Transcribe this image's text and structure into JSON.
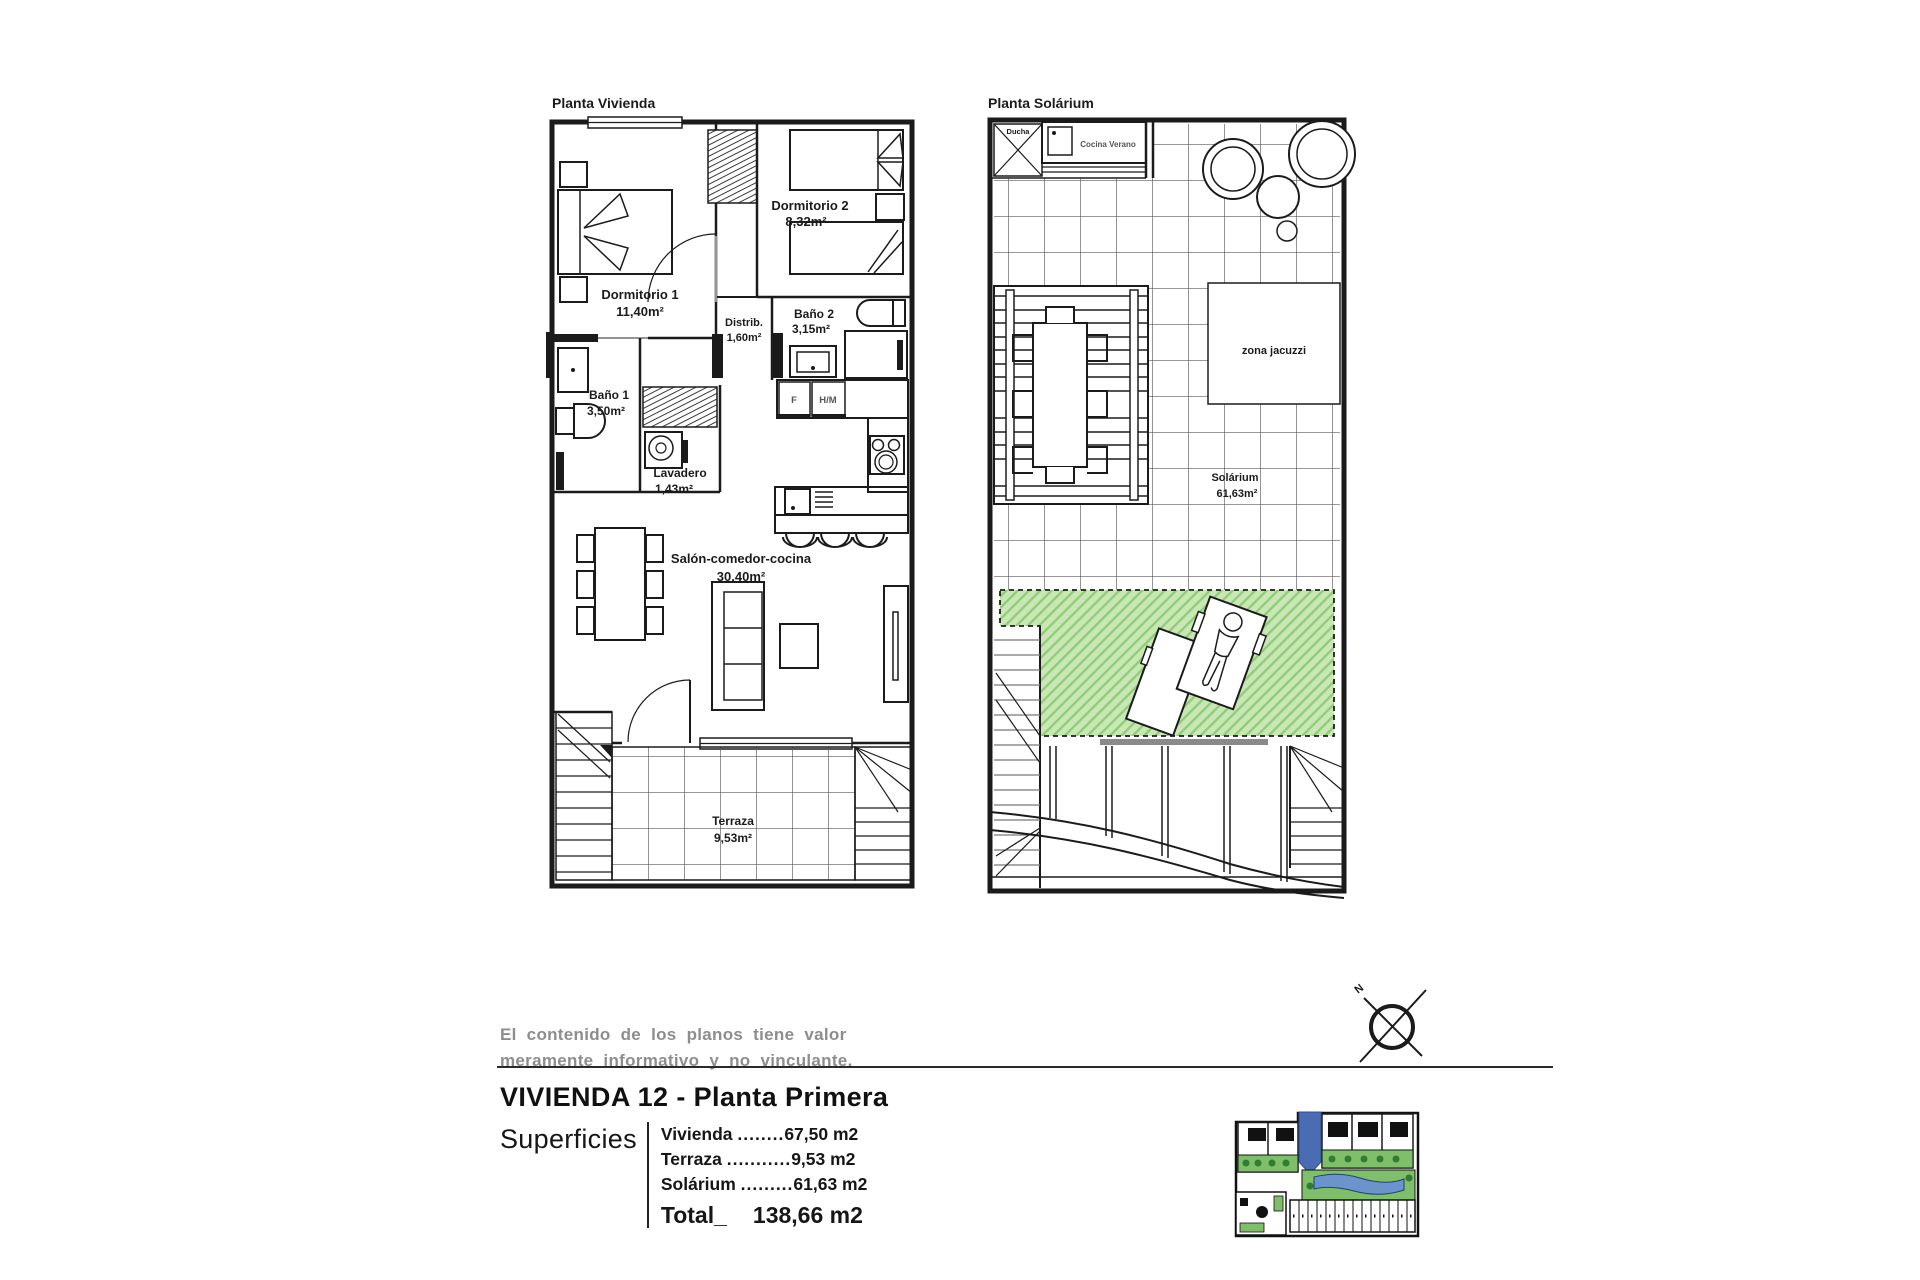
{
  "left_plan": {
    "title": "Planta Vivienda",
    "dormitorio1_name": "Dormitorio 1",
    "dormitorio1_area": "11,40m²",
    "dormitorio2_name": "Dormitorio 2",
    "dormitorio2_area": "8,32m²",
    "distrib_name": "Distrib.",
    "distrib_area": "1,60m²",
    "bano2_name": "Baño 2",
    "bano2_area": "3,15m²",
    "bano1_name": "Baño 1",
    "bano1_area": "3,50m²",
    "lavadero_name": "Lavadero",
    "lavadero_area": "1,43m²",
    "salon_name": "Salón-comedor-cocina",
    "salon_area": "30,40m²",
    "terraza_name": "Terraza",
    "terraza_area": "9,53m²",
    "fridge_label": "F",
    "oven_label": "H/M"
  },
  "right_plan": {
    "title": "Planta Solárium",
    "ducha_label": "Ducha",
    "cocina_verano_label": "Cocina Verano",
    "zona_jacuzzi_label": "zona jacuzzi",
    "solarium_name": "Solárium",
    "solarium_area": "61,63m²"
  },
  "footer": {
    "disclaimer_line1": "El contenido de los planos tiene valor",
    "disclaimer_line2": "meramente informativo y no vinculante.",
    "unit_title": "VIVIENDA 12 - Planta Primera",
    "superficies_label": "Superficies",
    "rows": [
      {
        "label": "Vivienda",
        "dots": "........",
        "value": "67,50 m2"
      },
      {
        "label": "Terraza",
        "dots": "...........",
        "value": "9,53 m2"
      },
      {
        "label": "Solárium",
        "dots": ".........",
        "value": "61,63 m2"
      }
    ],
    "total_label": "Total_",
    "total_value": "138,66 m2",
    "compass_n": "N"
  },
  "colors": {
    "line": "#1b1b1b",
    "gray_text": "#8d8d8d",
    "green_fill": "#c8e7b4",
    "green_hatch": "#8fcc78",
    "pool_blue": "#6b93cc",
    "highlight_blue": "#4a6cb3",
    "site_green": "#7fbf6a"
  }
}
